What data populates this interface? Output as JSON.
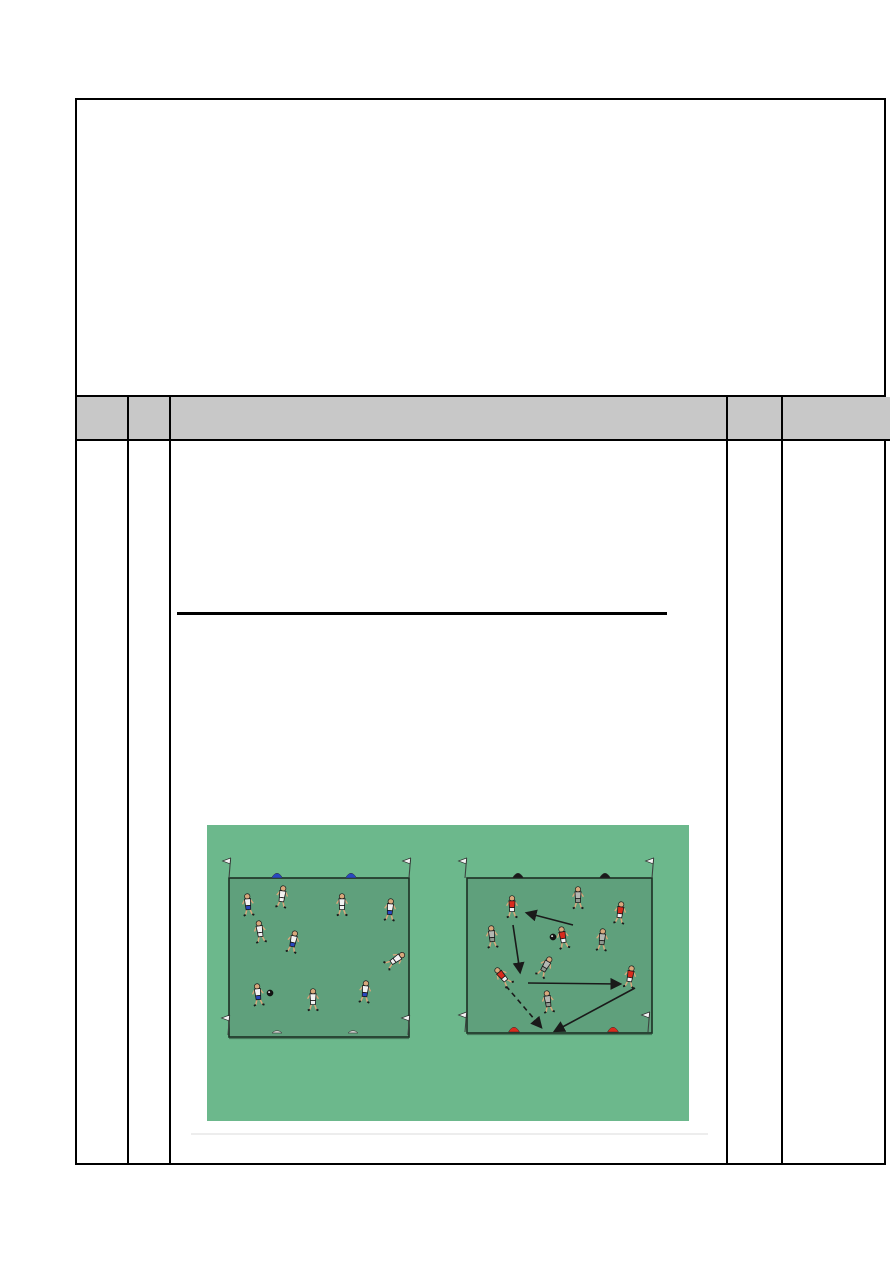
{
  "document": {
    "page_bg": "#ffffff",
    "line_color": "#000000",
    "top_box": {
      "content": ""
    },
    "table": {
      "header_fill": "#c8c8c8",
      "column_count": 5,
      "header_cells": [
        "",
        "",
        "",
        "",
        ""
      ],
      "body_cells": [
        "",
        "",
        "",
        "",
        ""
      ]
    },
    "heading": {
      "text": "",
      "underlined": true
    }
  },
  "diagram": {
    "bg": "#6cb88c",
    "field_fill": "#5fa07c",
    "field_stroke": "#1c2f24",
    "outline": "#1a1a1a",
    "skin": "#d8a87c",
    "team_colors": {
      "white_shirt": "#f2f2f2",
      "blue_shorts": "#2847c0",
      "red_shirt": "#d92b1c",
      "gray_shirt": "#b4b8b2",
      "gray_shorts": "#8f998f"
    },
    "fields": [
      {
        "id": "left-pitch",
        "x": 22,
        "y": 53,
        "w": 180,
        "h": 159
      },
      {
        "id": "right-pitch",
        "x": 260,
        "y": 53,
        "w": 185,
        "h": 155
      }
    ],
    "flags": [
      {
        "x": 22,
        "y": 53
      },
      {
        "x": 202,
        "y": 53
      },
      {
        "x": 21,
        "y": 210
      },
      {
        "x": 201,
        "y": 210
      },
      {
        "x": 258,
        "y": 53
      },
      {
        "x": 445,
        "y": 53
      },
      {
        "x": 258,
        "y": 207
      },
      {
        "x": 441,
        "y": 207
      }
    ],
    "cones": [
      {
        "x": 70,
        "y": 53,
        "color": "#2847c0",
        "shape": "dome"
      },
      {
        "x": 144,
        "y": 53,
        "color": "#2847c0",
        "shape": "dome"
      },
      {
        "x": 70,
        "y": 208,
        "color": "#c9cdc9",
        "shape": "flat"
      },
      {
        "x": 146,
        "y": 208,
        "color": "#c9cdc9",
        "shape": "flat"
      },
      {
        "x": 311,
        "y": 53,
        "color": "#1a1a1a",
        "shape": "dome"
      },
      {
        "x": 398,
        "y": 53,
        "color": "#1a1a1a",
        "shape": "dome"
      },
      {
        "x": 307,
        "y": 207,
        "color": "#d92b1c",
        "shape": "dome"
      },
      {
        "x": 406,
        "y": 207,
        "color": "#d92b1c",
        "shape": "dome"
      }
    ],
    "players": [
      {
        "x": 41,
        "y": 80,
        "shirt": "#f2f2f2",
        "shorts": "#2847c0",
        "rot": -5
      },
      {
        "x": 75,
        "y": 72,
        "shirt": "#f2f2f2",
        "shorts": "#f2f2f2",
        "rot": 8
      },
      {
        "x": 135,
        "y": 80,
        "shirt": "#f2f2f2",
        "shorts": "#f2f2f2",
        "rot": 0
      },
      {
        "x": 183,
        "y": 85,
        "shirt": "#f2f2f2",
        "shorts": "#2847c0",
        "rot": 5
      },
      {
        "x": 53,
        "y": 107,
        "shirt": "#f2f2f2",
        "shorts": "#f2f2f2",
        "rot": -8
      },
      {
        "x": 86,
        "y": 117,
        "shirt": "#f2f2f2",
        "shorts": "#2847c0",
        "rot": 12
      },
      {
        "x": 188,
        "y": 135,
        "shirt": "#f2f2f2",
        "shorts": "#f2f2f2",
        "rot": 55
      },
      {
        "x": 51,
        "y": 170,
        "shirt": "#f2f2f2",
        "shorts": "#2847c0",
        "rot": -6
      },
      {
        "x": 106,
        "y": 175,
        "shirt": "#f2f2f2",
        "shorts": "#f2f2f2",
        "rot": 0
      },
      {
        "x": 158,
        "y": 167,
        "shirt": "#f2f2f2",
        "shorts": "#2847c0",
        "rot": 6
      },
      {
        "x": 305,
        "y": 82,
        "shirt": "#d92b1c",
        "shorts": "#f2f2f2",
        "rot": 0
      },
      {
        "x": 371,
        "y": 73,
        "shirt": "#b4b8b2",
        "shorts": "#8f998f",
        "rot": 0
      },
      {
        "x": 413,
        "y": 88,
        "shirt": "#d92b1c",
        "shorts": "#f2f2f2",
        "rot": 8
      },
      {
        "x": 285,
        "y": 112,
        "shirt": "#b4b8b2",
        "shorts": "#8f998f",
        "rot": -5
      },
      {
        "x": 356,
        "y": 113,
        "shirt": "#d92b1c",
        "shorts": "#f2f2f2",
        "rot": -10
      },
      {
        "x": 395,
        "y": 115,
        "shirt": "#b4b8b2",
        "shorts": "#8f998f",
        "rot": 5
      },
      {
        "x": 296,
        "y": 152,
        "shirt": "#d92b1c",
        "shorts": "#f2f2f2",
        "rot": -40
      },
      {
        "x": 338,
        "y": 142,
        "shirt": "#b4b8b2",
        "shorts": "#8f998f",
        "rot": 30
      },
      {
        "x": 423,
        "y": 152,
        "shirt": "#d92b1c",
        "shorts": "#f2f2f2",
        "rot": 10
      },
      {
        "x": 341,
        "y": 177,
        "shirt": "#b4b8b2",
        "shorts": "#8f998f",
        "rot": -8
      }
    ],
    "balls": [
      {
        "x": 63,
        "y": 168
      },
      {
        "x": 346,
        "y": 112
      }
    ],
    "arrows": [
      {
        "x1": 366,
        "y1": 100,
        "x2": 320,
        "y2": 88,
        "dashed": false
      },
      {
        "x1": 306,
        "y1": 100,
        "x2": 313,
        "y2": 147,
        "dashed": false
      },
      {
        "x1": 321,
        "y1": 158,
        "x2": 413,
        "y2": 159,
        "dashed": false
      },
      {
        "x1": 428,
        "y1": 163,
        "x2": 348,
        "y2": 206,
        "dashed": false
      },
      {
        "x1": 299,
        "y1": 161,
        "x2": 334,
        "y2": 202,
        "dashed": true
      }
    ]
  }
}
